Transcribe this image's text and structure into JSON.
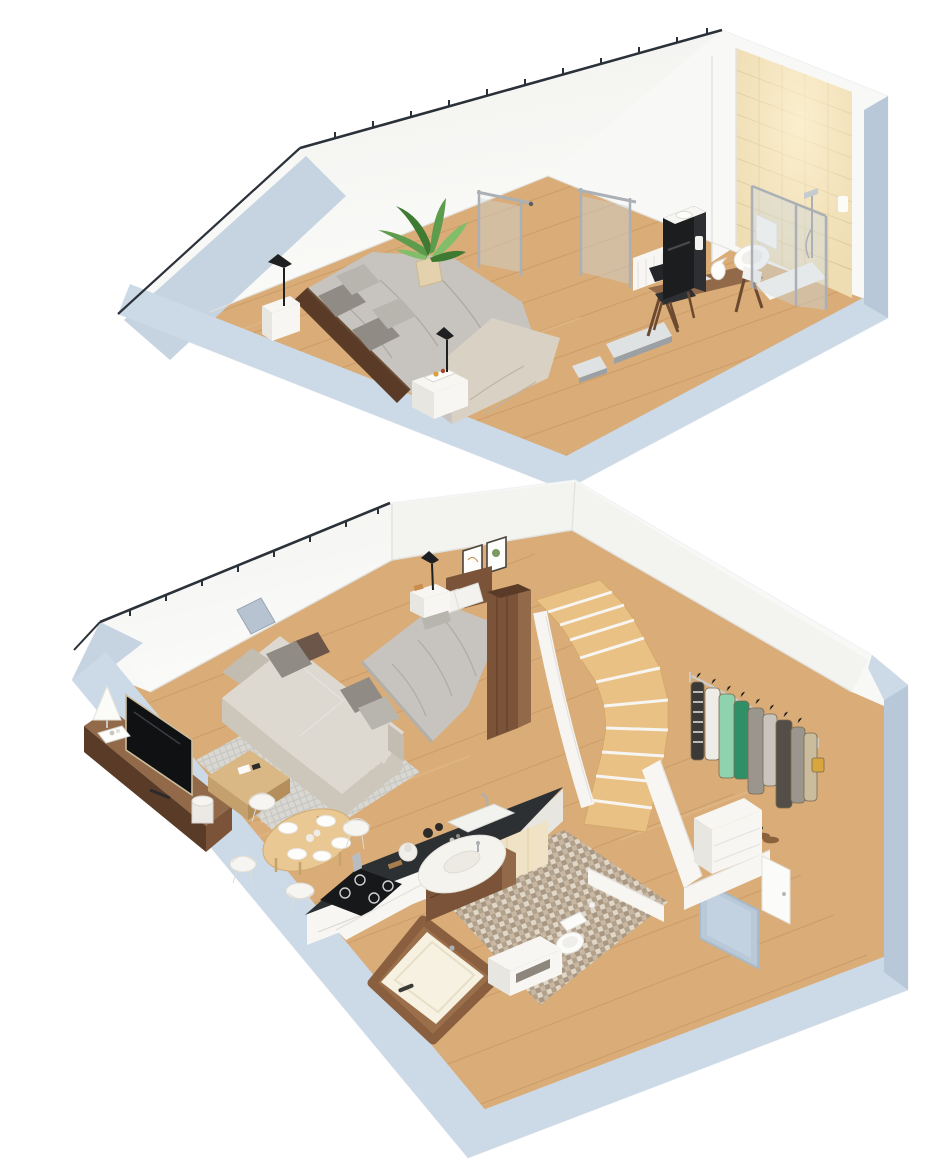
{
  "scene": {
    "type": "isometric-cutaway-floor-plan",
    "floors": [
      {
        "id": "upper-floor",
        "rooms": [
          {
            "id": "attic-bedroom",
            "furniture": [
              "double-bed",
              "headboard",
              "nightstand",
              "table-lamp",
              "breakfast-tray",
              "potted-plant"
            ]
          },
          {
            "id": "workspace",
            "furniture": [
              "desk",
              "desk-chair",
              "laptop",
              "pitcher",
              "radiator"
            ]
          },
          {
            "id": "upper-bathroom",
            "furniture": [
              "tiled-wall",
              "shower",
              "toilet",
              "vanity-cabinet"
            ]
          },
          {
            "id": "stair-landing",
            "furniture": [
              "glass-railing",
              "floor-openings"
            ]
          }
        ]
      },
      {
        "id": "lower-floor",
        "rooms": [
          {
            "id": "living-room",
            "furniture": [
              "corner-sofa",
              "pillows",
              "tv",
              "media-console",
              "table-lamp",
              "coffee-table",
              "rug",
              "vase"
            ]
          },
          {
            "id": "dining-area",
            "furniture": [
              "round-table",
              "plates",
              "wire-chairs"
            ]
          },
          {
            "id": "kitchen",
            "furniture": [
              "island-counter",
              "gas-hob",
              "sink",
              "coffee-pot",
              "jars"
            ]
          },
          {
            "id": "lower-bedroom",
            "furniture": [
              "double-bed",
              "wall-art",
              "nightstand",
              "table-lamp",
              "walnut-wardrobe"
            ]
          },
          {
            "id": "lower-bathroom",
            "furniture": [
              "bathtub",
              "vanity",
              "toilet",
              "storage-bench",
              "mosaic-floor",
              "cream-cabinets"
            ]
          },
          {
            "id": "hallway",
            "furniture": [
              "winder-stairs",
              "clothes-rail",
              "shoes",
              "drawer-unit",
              "entry-door",
              "interior-door",
              "skylight"
            ]
          }
        ]
      }
    ],
    "palette": {
      "bg": "#ffffff",
      "wall_cut": "#ccd9e6",
      "wall_cut_dark": "#b8c8d8",
      "wall_cut_light": "#dbe4ee",
      "roof_slope": "#c6d3e1",
      "wall_white": "#f8f8f6",
      "wall_tint": "#f0f0ed",
      "ridge": "#2b3138",
      "floor_wood": "#d9ac78",
      "floor_wood_dark": "#c2915c",
      "floor_wood_light": "#e8c694",
      "stair_wood": "#eac185",
      "rug": "#d8d7d2",
      "rug_line": "#c5c4be",
      "sofa": "#ded9d0",
      "sofa_shade": "#cdc6ba",
      "sofa_dark": "#c3bcb0",
      "pillow_gray": "#908c85",
      "pillow_light": "#b8b4ae",
      "pillow_brown": "#6b5649",
      "walnut": "#7a5338",
      "walnut_dark": "#5a3b27",
      "walnut_light": "#936a49",
      "duvet": "#c7c4bf",
      "duvet_shade": "#aca8a2",
      "linen": "#d9d2c4",
      "tile": "#eedcb2",
      "tile_grout": "#d8c192",
      "mosaic_a": "#c8b8a3",
      "mosaic_b": "#b2a28c",
      "mosaic_c": "#e0d7c8",
      "mosaic_d": "#8e7e67",
      "glass": "rgba(205,215,222,0.42)",
      "chrome": "#aab0b6",
      "black": "#1c1d1f",
      "tv_black": "#101113",
      "counter": "#2c3033",
      "cream": "#f0e3c5",
      "cream_dark": "#e2d0a8",
      "plant": "#5d9c4c",
      "plant_dark": "#3f7a33",
      "plant_light": "#82bd6a",
      "white_furniture": "#f7f6f2",
      "white_furniture_shade": "#e8e6e0",
      "door_blue": "#b9c9d8",
      "skylight": "#b7c3d0",
      "tub_cream": "#f6f1e0",
      "line_soft": "#e3e2de",
      "clothes_green": "#8fd3ae",
      "clothes_teal": "#2f8f67",
      "clothes_gray": "#9a968e",
      "clothes_charcoal": "#534f48",
      "clothes_white": "#eeece6",
      "clothes_tan": "#cbbc9e",
      "clothes_yellow": "#d9a63e",
      "clothes_stripe": "#3c3a36",
      "shoe_brown": "#8a623c"
    }
  }
}
